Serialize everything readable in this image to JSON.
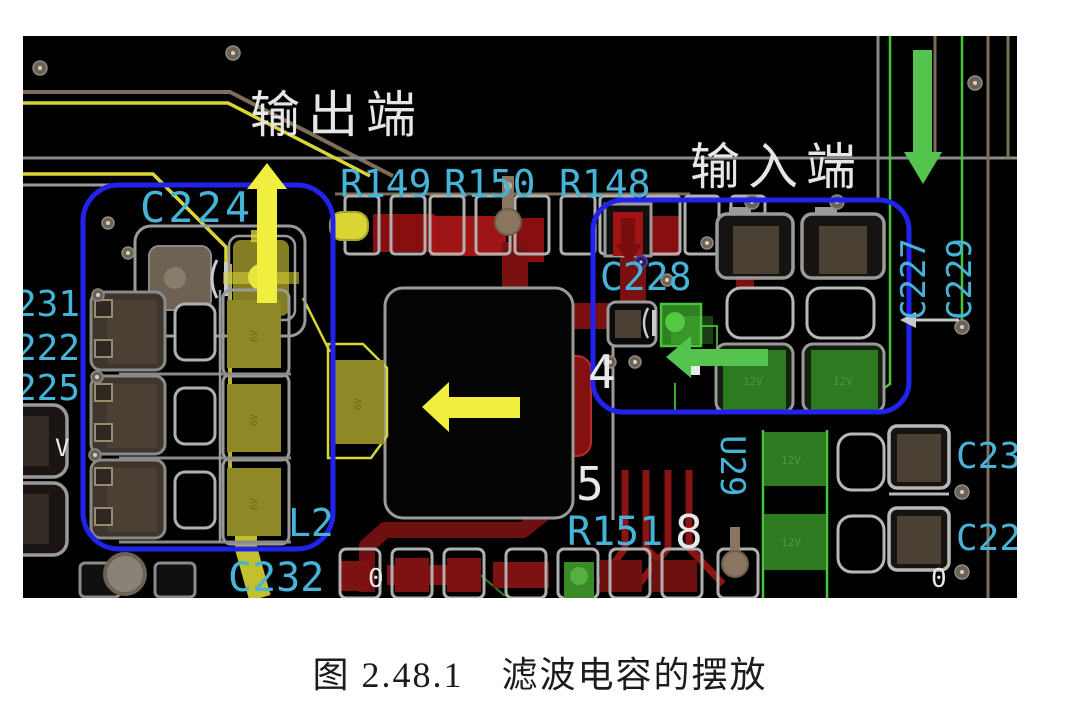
{
  "figure": {
    "caption": "图 2.48.1　滤波电容的摆放"
  },
  "pcb": {
    "annotations": {
      "output": "输出端",
      "input": "输入端"
    },
    "designators": {
      "c224": "C224",
      "r149": "R149",
      "r150": "R150",
      "r148": "R148",
      "c228": "C228",
      "c227": "C227",
      "c229": "C229",
      "edge1": "231",
      "edge2": "222",
      "edge3": "225",
      "l2": "L2",
      "c232": "C232",
      "r151": "R151",
      "u29": "U29",
      "c23": "C23",
      "c22": "C22"
    },
    "pins": {
      "p4": "4",
      "p5": "5",
      "p8": "8",
      "v_mark": "V",
      "zero": "0"
    },
    "markings": {
      "v6": "6V",
      "v12": "12V"
    },
    "icons": {
      "yellow_up_arrow": "arrow-up",
      "yellow_left_arrow": "arrow-left",
      "green_left_arrow": "arrow-left",
      "green_down_arrow": "arrow-down",
      "white_left_arrow": "arrow-left",
      "left_highlight_box": "rounded-rect",
      "right_highlight_box": "rounded-rect"
    },
    "colors": {
      "board": "#000000",
      "silkscreen_cyan": "#45b4d8",
      "highlight_blue": "#2222ee",
      "arrow_yellow": "#f0ee3e",
      "arrow_green": "#55c44e",
      "copper_red_bright": "#a81414",
      "copper_red_dark": "#6e1010",
      "trace_brown": "#7d6e58",
      "trace_grey": "#9a9a9a",
      "cap_olive": "#8e8826",
      "cap_green": "#2d7a20",
      "annotation_white": "#e6e6e6"
    }
  }
}
